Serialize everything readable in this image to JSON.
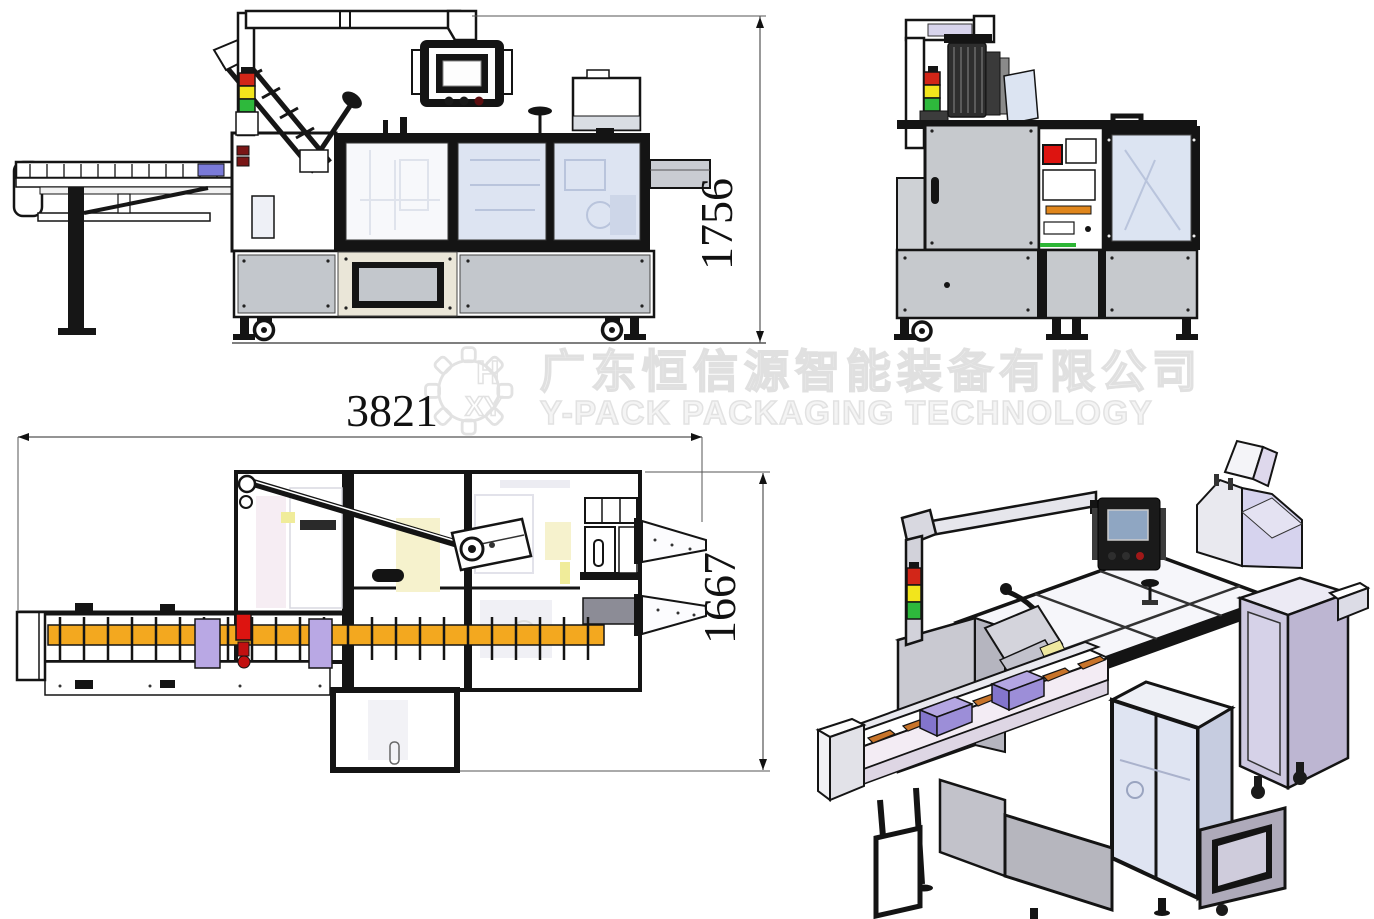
{
  "drawing": {
    "type": "engineering-drawing",
    "subject": "cartoning packaging machine, four orthographic/isometric views",
    "background": "#ffffff"
  },
  "dimensions": {
    "height": "1756",
    "length": "3821",
    "width": "1667"
  },
  "watermark": {
    "company_cn": "广东恒信源智能装备有限公司",
    "company_en": "Y-PACK PACKAGING TECHNOLOGY",
    "logo_letters_top": "H",
    "logo_letters_bottom": "XY"
  },
  "views": {
    "side": "front-elevation",
    "end": "side-elevation",
    "plan": "top-plan",
    "iso": "isometric-3d"
  },
  "colors": {
    "signal_red": "#d22618",
    "signal_yellow": "#f2e51c",
    "signal_green": "#2eb93c",
    "conveyor_orange": "#f3a81f",
    "product_purple": "#b9a8e4",
    "conveyor_blue": "#7a7ad8",
    "glass_blue": "#dde4f2",
    "lavender_panel": "#d6d3ee",
    "machine_gray": "#c6c9cd",
    "panel_cream": "#eae6d8",
    "estop_red": "#dd1410",
    "strip_orange": "#e0861c",
    "frame_black": "#141414",
    "watermark_gray": "#e2e2e2"
  }
}
